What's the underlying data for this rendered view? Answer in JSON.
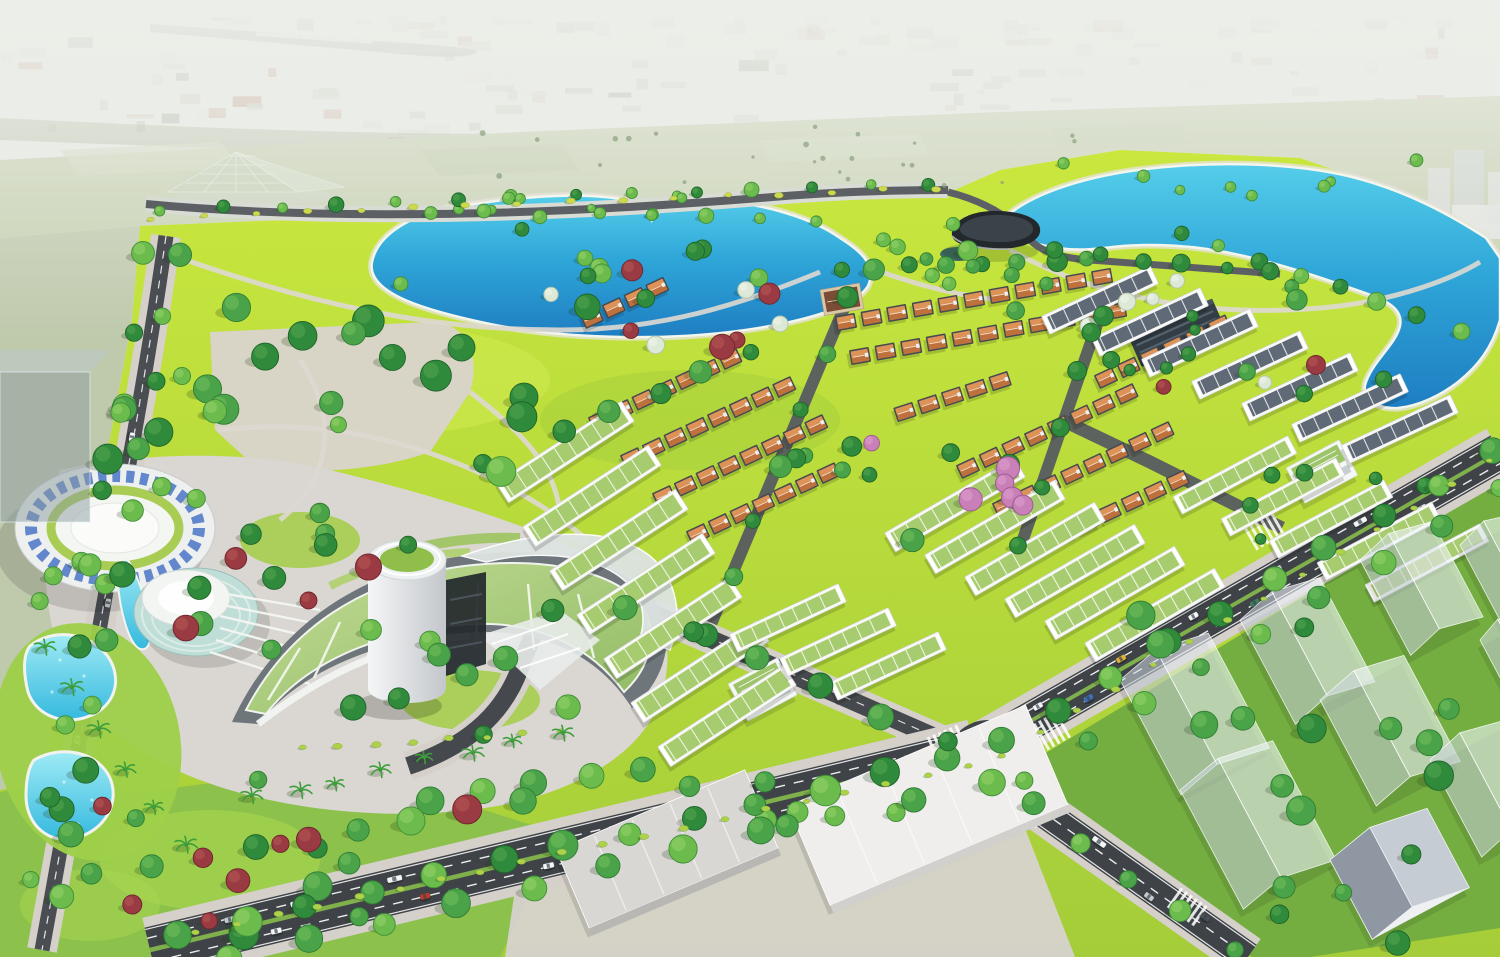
{
  "meta": {
    "description": "Aerial 3D architectural rendering of a planned urban residential development: a large landscaped park with two turquoise lakes and a lattice pyramid landmark, rows of orange-roofed villas and white green-roofed townhouses, a curved glass resort complex with an elliptical ring building, teal drum, cylindrical tower and swimming pools, tree-lined boulevards with cars, translucent future building blocks, warehouses, all set against a hazy city skyline with a river and bridge.",
    "type": "3d-masterplan-rendering",
    "view": "aerial-perspective"
  },
  "palette": {
    "haze": "#e9ebe6",
    "city_light": "#d7dad2",
    "river": "#b3b5b0",
    "bridge": "#e8e8e4",
    "field": "#c6d0af",
    "greenbelt": "#a9b394",
    "lawn_bright": "#c9e73e",
    "lawn_mid": "#a4cd39",
    "lawn_ghost": "#74ae41",
    "garden": "#8cc14b",
    "lake_top": "#55cdea",
    "lake_deep": "#1e7ec2",
    "pool_top": "#9febf5",
    "pool_deep": "#35b9de",
    "road": "#3f4347",
    "road_minor": "#565b5f",
    "sidewalk": "#d5d0ca",
    "median": "#7fb04c",
    "lane": "#ffffff",
    "roof_orange": "#dd9257",
    "roof_orange_dark": "#b96a38",
    "roof_green": "#a7cb6f",
    "roof_gray": "#5f6a76",
    "body_dark": "#454a50",
    "body_white": "#f6f7f7",
    "glass_green": "#a9cc79",
    "ring_blue": "#4a74c6",
    "ghost_fill": "rgba(238,243,248,0.6)",
    "warehouse": "#e9e8e5",
    "trees": {
      "g1": {
        "f": "#4aa348",
        "s": "#2f7d33",
        "h": "#78c25c"
      },
      "g2": {
        "f": "#6cbb4d",
        "s": "#3f8f38",
        "h": "#9ad56b"
      },
      "g3": {
        "f": "#2f8a3c",
        "s": "#1f6329",
        "h": "#57a84e"
      },
      "red": {
        "f": "#9a3a42",
        "s": "#6f252c",
        "h": "#b85a57"
      },
      "blossom": {
        "f": "#dde9d7",
        "s": "#b2c4ab",
        "h": "#f2f7ee"
      },
      "pink": {
        "f": "#c97fb7",
        "s": "#9c5890",
        "h": "#e0a3d0"
      },
      "palm": {
        "f": "#3f9e3c",
        "s": "#2c7a2b",
        "h": "#5cb84f"
      },
      "shrub": {
        "f": "#aed14a",
        "s": "#8ab23a",
        "h": "#cfe468"
      },
      "yshrub": {
        "f": "#cbd94e",
        "s": "#a8b53c",
        "h": "#e4ec72"
      },
      "dot": {
        "f": "#8aa07e",
        "s": "#8aa07e",
        "h": "#8aa07e"
      }
    },
    "cars": {
      "white": "#f4f5f6",
      "silver": "#c7cbce",
      "dark": "#4a4f54",
      "red": "#c0392b",
      "yellow": "#e0b23c",
      "blue": "#3f6fb5",
      "green": "#3e7d5a"
    }
  },
  "scene": {
    "background": {
      "city_blocks": {
        "count": 150,
        "seed": 41
      },
      "river": true,
      "bridge": true,
      "pyramid_landmark": true,
      "far_towers": true
    },
    "water": {
      "lakes": [
        "central-lake",
        "east-lake"
      ],
      "pools": 3
    },
    "legend": {
      "tree_lines": "[x1,y1,x2,y2,count,radius,kinds[]] trees placed evenly along a line",
      "tree_clusters": "[cx,cy,rx,ry,count,rmin,rmax,kinds[],seed] trees scattered in ellipse",
      "shrub_lines": "[x1,y1,x2,y2,count,kind]",
      "palm_lines": "[x1,y1,x2,y2,count]",
      "villa_rows": "[x,y,angleDeg,count,spacing] detached villas with orange hip roofs",
      "strip_rows": "[cx,cy,angleDeg,length,width,roofKey] terraced townhouse strips",
      "ghost_buildings": "[x,y,w,h,solidFlag] translucent future blocks, rotated -28deg",
      "warehouses": "[x,y,length,width,angleDeg,roofColor,sideColor]",
      "cars_items": "[segmentKey,t,offset,colorKey,length]",
      "crosswalks": "[cx,cy,angleDeg,halfRoadWidth]"
    },
    "tree_lines": [
      [
        180,
        936,
        950,
        758,
        13,
        13,
        [
          "g1",
          "g2",
          "g3"
        ]
      ],
      [
        232,
        957,
        990,
        780,
        11,
        12,
        [
          "g2",
          "g1"
        ]
      ],
      [
        1000,
        740,
        1490,
        452,
        10,
        11,
        [
          "g1",
          "g3",
          "g2"
        ]
      ],
      [
        1026,
        778,
        1500,
        490,
        9,
        10,
        [
          "g2",
          "g1"
        ]
      ],
      [
        176,
        252,
        62,
        898,
        11,
        10,
        [
          "g1",
          "g2",
          "g3"
        ]
      ],
      [
        146,
        254,
        34,
        878,
        9,
        9,
        [
          "g2",
          "g3"
        ]
      ],
      [
        162,
        210,
        930,
        184,
        14,
        6,
        [
          "g2",
          "g3"
        ]
      ],
      [
        1030,
        804,
        1232,
        950,
        5,
        10,
        [
          "g1",
          "g2"
        ]
      ],
      [
        848,
        298,
        708,
        634,
        7,
        9,
        [
          "g3",
          "g1"
        ]
      ],
      [
        1100,
        314,
        1020,
        546,
        5,
        9,
        [
          "g3"
        ]
      ],
      [
        628,
        606,
        946,
        742,
        6,
        10,
        [
          "g1",
          "g3"
        ]
      ],
      [
        838,
        268,
        1090,
        258,
        8,
        9,
        [
          "g3",
          "g1"
        ]
      ],
      [
        430,
        212,
        818,
        220,
        8,
        6,
        [
          "g2"
        ]
      ],
      [
        1180,
        232,
        1458,
        330,
        8,
        7,
        [
          "g3",
          "g2"
        ]
      ],
      [
        1055,
        250,
        1270,
        272,
        6,
        7,
        [
          "g3"
        ]
      ],
      [
        432,
        798,
        642,
        768,
        5,
        11,
        [
          "g1",
          "g2"
        ]
      ],
      [
        148,
        864,
        520,
        802,
        8,
        12,
        [
          "g1",
          "red",
          "g3",
          "red",
          "g1",
          "g2",
          "red",
          "g1"
        ]
      ],
      [
        566,
        430,
        748,
        352,
        5,
        9,
        [
          "g3",
          "g1"
        ]
      ],
      [
        930,
        260,
        1050,
        285,
        4,
        8,
        [
          "g1"
        ]
      ]
    ],
    "tree_clusters": [
      [
        340,
        430,
        240,
        140,
        26,
        8,
        16,
        [
          "g1",
          "g2",
          "g3"
        ],
        3
      ],
      [
        600,
        262,
        240,
        40,
        10,
        6,
        10,
        [
          "g2",
          "g3"
        ],
        5
      ],
      [
        948,
        250,
        80,
        36,
        6,
        6,
        10,
        [
          "g2"
        ],
        7
      ],
      [
        1205,
        330,
        205,
        60,
        12,
        6,
        11,
        [
          "g1",
          "g3",
          "red",
          "blossom"
        ],
        9
      ],
      [
        330,
        592,
        180,
        80,
        12,
        8,
        14,
        [
          "g1",
          "g2",
          "g3",
          "red"
        ],
        11
      ],
      [
        262,
        842,
        230,
        98,
        14,
        8,
        15,
        [
          "g1",
          "red",
          "g3"
        ],
        13
      ],
      [
        1272,
        692,
        210,
        148,
        12,
        9,
        15,
        [
          "g1",
          "g3"
        ],
        15
      ],
      [
        792,
        796,
        140,
        36,
        6,
        8,
        12,
        [
          "g1",
          "g2"
        ],
        17
      ],
      [
        930,
        468,
        140,
        74,
        14,
        7,
        12,
        [
          "g3",
          "g1",
          "g3",
          "pink"
        ],
        19
      ],
      [
        1270,
        352,
        170,
        58,
        8,
        5,
        9,
        [
          "g3"
        ],
        21
      ],
      [
        432,
        662,
        160,
        88,
        9,
        8,
        13,
        [
          "g1",
          "g2",
          "g3"
        ],
        23
      ],
      [
        1242,
        178,
        240,
        28,
        8,
        4,
        7,
        [
          "g2"
        ],
        25
      ],
      [
        622,
        206,
        230,
        24,
        8,
        4,
        7,
        [
          "g2"
        ],
        27
      ],
      [
        850,
        152,
        560,
        34,
        24,
        1.5,
        3,
        [
          "dot"
        ],
        29
      ],
      [
        1332,
        522,
        140,
        58,
        6,
        5,
        9,
        [
          "g3"
        ],
        31
      ],
      [
        1382,
        900,
        120,
        48,
        5,
        8,
        13,
        [
          "g1",
          "g3"
        ],
        33
      ],
      [
        64,
        582,
        58,
        58,
        4,
        7,
        11,
        [
          "g2"
        ],
        35
      ],
      [
        700,
        300,
        150,
        55,
        10,
        7,
        13,
        [
          "g1",
          "g3",
          "blossom",
          "red"
        ],
        37
      ]
    ],
    "shrub_lines": [
      [
        196,
        932,
        968,
        766,
        20,
        "shrub"
      ],
      [
        1002,
        756,
        1490,
        462,
        14,
        "shrub"
      ],
      [
        152,
        218,
        936,
        188,
        16,
        "yshrub"
      ],
      [
        302,
        748,
        560,
        732,
        8,
        "shrub"
      ]
    ],
    "palm_lines": [
      [
        42,
        652,
        188,
        846,
        6
      ],
      [
        252,
        798,
        560,
        736,
        8
      ]
    ],
    "villa_rows": [
      [
        592,
        318,
        -25,
        4,
        24
      ],
      [
        600,
        420,
        -25,
        7,
        24
      ],
      [
        632,
        458,
        -25,
        8,
        24
      ],
      [
        664,
        496,
        -25,
        8,
        24
      ],
      [
        698,
        534,
        -25,
        7,
        24
      ],
      [
        846,
        322,
        -10,
        11,
        26
      ],
      [
        860,
        356,
        -10,
        11,
        26
      ],
      [
        905,
        412,
        -18,
        5,
        25
      ],
      [
        968,
        468,
        -25,
        8,
        25
      ],
      [
        1004,
        506,
        -25,
        8,
        25
      ],
      [
        1042,
        544,
        -25,
        7,
        25
      ],
      [
        1106,
        378,
        -25,
        6,
        25
      ]
    ],
    "strip_rows": [
      [
        565,
        452,
        -33,
        150,
        24,
        "green"
      ],
      [
        592,
        496,
        -33,
        150,
        24,
        "green"
      ],
      [
        619,
        540,
        -33,
        150,
        24,
        "green"
      ],
      [
        646,
        584,
        -33,
        150,
        24,
        "green"
      ],
      [
        673,
        628,
        -33,
        150,
        24,
        "green"
      ],
      [
        700,
        672,
        -33,
        150,
        24,
        "green"
      ],
      [
        727,
        716,
        -33,
        150,
        24,
        "green"
      ],
      [
        955,
        505,
        -30,
        150,
        22,
        "green"
      ],
      [
        995,
        527,
        -30,
        150,
        22,
        "green"
      ],
      [
        1035,
        549,
        -30,
        150,
        22,
        "green"
      ],
      [
        1075,
        571,
        -30,
        150,
        22,
        "green"
      ],
      [
        1115,
        593,
        -30,
        150,
        22,
        "green"
      ],
      [
        1155,
        615,
        -30,
        150,
        22,
        "green"
      ],
      [
        1235,
        475,
        -28,
        130,
        20,
        "green"
      ],
      [
        1283,
        497,
        -28,
        130,
        20,
        "green"
      ],
      [
        1331,
        519,
        -28,
        130,
        20,
        "green"
      ],
      [
        1379,
        541,
        -28,
        130,
        20,
        "green"
      ],
      [
        1427,
        563,
        -28,
        130,
        20,
        "green"
      ],
      [
        1100,
        300,
        -25,
        120,
        20,
        "gray"
      ],
      [
        1150,
        322,
        -25,
        120,
        20,
        "gray"
      ],
      [
        1200,
        343,
        -25,
        120,
        20,
        "gray"
      ],
      [
        1250,
        365,
        -25,
        120,
        20,
        "gray"
      ],
      [
        1300,
        387,
        -25,
        120,
        20,
        "gray"
      ],
      [
        1350,
        408,
        -25,
        120,
        20,
        "gray"
      ],
      [
        1400,
        429,
        -25,
        120,
        20,
        "gray"
      ],
      [
        788,
        618,
        -25,
        120,
        20,
        "green"
      ],
      [
        838,
        642,
        -25,
        120,
        20,
        "green"
      ],
      [
        888,
        666,
        -25,
        120,
        20,
        "green"
      ]
    ],
    "ghost_buildings": [
      [
        1120,
        680,
        100,
        130,
        0
      ],
      [
        1240,
        620,
        90,
        118,
        0
      ],
      [
        1360,
        560,
        82,
        108,
        0
      ],
      [
        1460,
        545,
        70,
        95,
        0
      ],
      [
        1180,
        790,
        105,
        135,
        0
      ],
      [
        1320,
        700,
        95,
        120,
        0
      ],
      [
        1430,
        760,
        85,
        110,
        0
      ],
      [
        1330,
        860,
        110,
        90,
        1
      ],
      [
        1480,
        640,
        55,
        80,
        0
      ]
    ],
    "warehouses": [
      [
        556,
        850,
        205,
        85,
        -23,
        "#d8d7d4",
        "#b9b7b4"
      ],
      [
        788,
        806,
        258,
        108,
        -23,
        "#efeeec",
        "#d2d0cd"
      ]
    ],
    "cars": {
      "segments": {
        "b": [
          150,
          950,
          975,
          752
        ],
        "a": [
          980,
          750,
          1500,
          452
        ],
        "d": [
          1012,
          790,
          1248,
          957
        ],
        "l": [
          160,
          300,
          60,
          850
        ]
      },
      "items": [
        [
          "b",
          0.1,
          -11,
          "silver",
          11
        ],
        [
          "b",
          0.18,
          -11,
          "white",
          11
        ],
        [
          "b",
          0.3,
          -12,
          "white",
          15
        ],
        [
          "b",
          0.44,
          -11,
          "dark",
          11
        ],
        [
          "b",
          0.58,
          -12,
          "white",
          11
        ],
        [
          "b",
          0.72,
          -11,
          "silver",
          11
        ],
        [
          "b",
          0.15,
          11,
          "white",
          11
        ],
        [
          "b",
          0.33,
          12,
          "red",
          10
        ],
        [
          "b",
          0.48,
          11,
          "white",
          11
        ],
        [
          "b",
          0.62,
          11,
          "dark",
          11
        ],
        [
          "b",
          0.78,
          12,
          "white",
          15
        ],
        [
          "a",
          0.12,
          -9,
          "white",
          10
        ],
        [
          "a",
          0.28,
          -9,
          "yellow",
          10
        ],
        [
          "a",
          0.42,
          -10,
          "white",
          10
        ],
        [
          "a",
          0.58,
          -9,
          "silver",
          10
        ],
        [
          "a",
          0.74,
          -9,
          "white",
          14
        ],
        [
          "a",
          0.2,
          9,
          "blue",
          10
        ],
        [
          "a",
          0.36,
          10,
          "white",
          10
        ],
        [
          "a",
          0.52,
          9,
          "green",
          10
        ],
        [
          "a",
          0.68,
          9,
          "red",
          10
        ],
        [
          "a",
          0.84,
          10,
          "white",
          10
        ],
        [
          "d",
          0.35,
          -8,
          "white",
          15
        ],
        [
          "d",
          0.6,
          8,
          "silver",
          10
        ],
        [
          "d",
          0.8,
          -8,
          "dark",
          10
        ],
        [
          "l",
          0.25,
          3,
          "white",
          9
        ],
        [
          "l",
          0.55,
          -3,
          "silver",
          9
        ],
        [
          "l",
          0.8,
          3,
          "white",
          9
        ]
      ]
    },
    "crosswalks": [
      [
        924,
        778,
        -13.8,
        19
      ],
      [
        1048,
        733,
        -29.8,
        15
      ],
      [
        1028,
        808,
        35.4,
        12
      ],
      [
        944,
        740,
        -23,
        9
      ],
      [
        1186,
        906,
        35.4,
        12
      ],
      [
        1262,
        530,
        -29.8,
        15
      ]
    ]
  }
}
